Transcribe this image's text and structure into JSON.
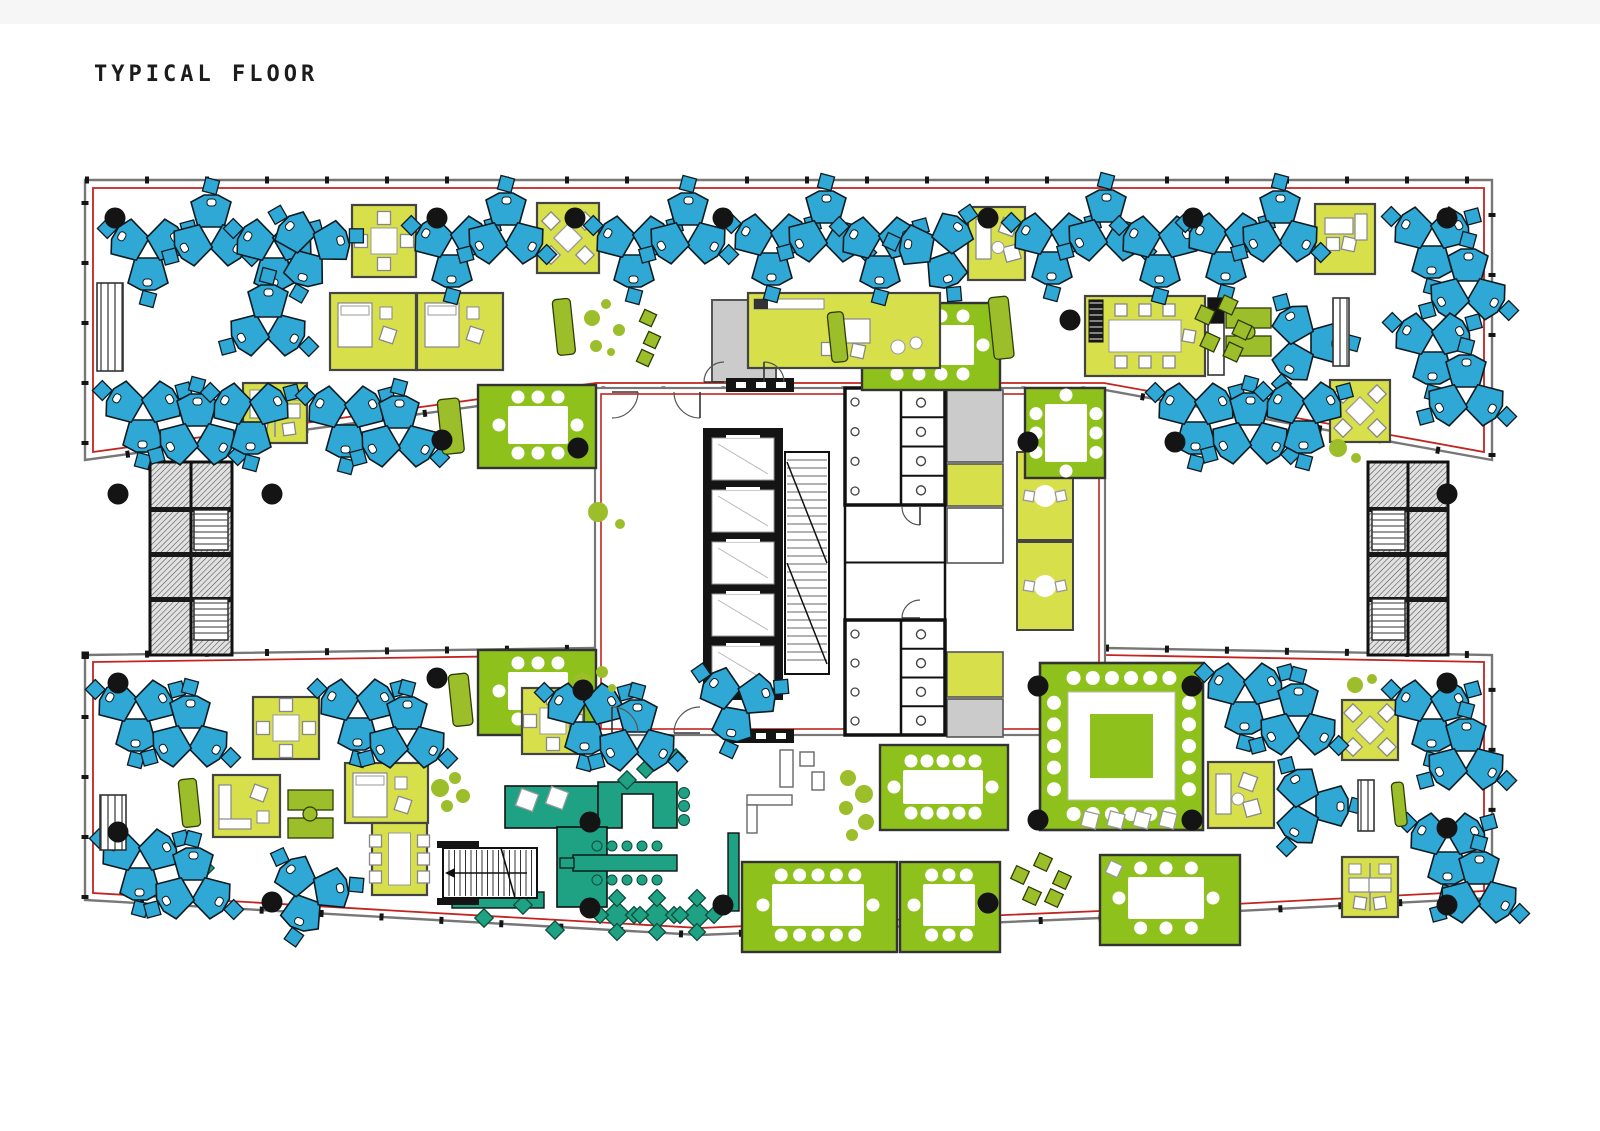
{
  "title": "TYPICAL FLOOR",
  "palette": {
    "blue": "#2FA8D5",
    "lime": "#D7DF4B",
    "green": "#8FC11C",
    "teal": "#1FA183",
    "olive": "#9CBE2B",
    "red": "#C22420",
    "wall": "#6E6E6E",
    "black": "#141414",
    "grayRoom": "#CBCBCB",
    "white": "#FFFFFF",
    "chairStroke": "#888888"
  },
  "plan": {
    "wings": {
      "top": {
        "outer": [
          [
            85,
            180
          ],
          [
            1492,
            180
          ],
          [
            1492,
            460
          ],
          [
            1105,
            390
          ],
          [
            595,
            390
          ],
          [
            85,
            460
          ]
        ],
        "red": [
          [
            93,
            188
          ],
          [
            1484,
            188
          ],
          [
            1484,
            452
          ],
          [
            1104,
            383
          ],
          [
            596,
            383
          ],
          [
            93,
            452
          ]
        ]
      },
      "bottom": {
        "outer": [
          [
            85,
            655
          ],
          [
            595,
            648
          ],
          [
            1105,
            648
          ],
          [
            1492,
            655
          ],
          [
            1492,
            898
          ],
          [
            1100,
            918
          ],
          [
            700,
            935
          ],
          [
            400,
            918
          ],
          [
            85,
            900
          ]
        ],
        "red": [
          [
            93,
            662
          ],
          [
            595,
            655
          ],
          [
            1105,
            655
          ],
          [
            1484,
            662
          ],
          [
            1484,
            891
          ],
          [
            1100,
            911
          ],
          [
            700,
            928
          ],
          [
            400,
            911
          ],
          [
            93,
            893
          ]
        ]
      }
    },
    "core": {
      "rect": [
        595,
        388,
        510,
        347
      ],
      "red": [
        601,
        394,
        498,
        335
      ],
      "grayRoom": [
        712,
        300,
        64,
        82
      ],
      "bars": [
        [
          726,
          378,
          68,
          14
        ],
        [
          726,
          729,
          68,
          14
        ]
      ],
      "elevBank": [
        703,
        428,
        80,
        272
      ],
      "carSize": [
        62,
        42
      ],
      "cars": [
        [
          712,
          438
        ],
        [
          712,
          490
        ],
        [
          712,
          542
        ],
        [
          712,
          594
        ],
        [
          712,
          646
        ]
      ],
      "scissor": [
        785,
        452,
        44,
        222
      ],
      "bathTop": [
        845,
        388,
        100,
        117
      ],
      "bathBottom": [
        845,
        620,
        100,
        115
      ],
      "midRooms": [
        845,
        505,
        100,
        115
      ],
      "grayCells": [
        [
          947,
          390,
          56,
          72
        ],
        [
          947,
          699,
          56,
          38
        ]
      ],
      "limeCells": [
        [
          947,
          464,
          56,
          42
        ],
        [
          947,
          652,
          56,
          45
        ]
      ],
      "whiteCells": [
        [
          947,
          508,
          56,
          55
        ]
      ],
      "phoneRooms": [
        [
          1017,
          452,
          56,
          88
        ],
        [
          1017,
          542,
          56,
          88
        ]
      ]
    },
    "extStairs": [
      [
        150,
        462,
        82,
        193,
        0
      ],
      [
        1368,
        462,
        80,
        193,
        1
      ]
    ],
    "cafeStair": [
      443,
      848,
      94,
      50
    ],
    "pods": [
      [
        148,
        252,
        90
      ],
      [
        211,
        233,
        270
      ],
      [
        274,
        252,
        90
      ],
      [
        311,
        248,
        105
      ],
      [
        452,
        249,
        90
      ],
      [
        506,
        231,
        270
      ],
      [
        634,
        249,
        90
      ],
      [
        688,
        231,
        270
      ],
      [
        772,
        247,
        90
      ],
      [
        826,
        229,
        270
      ],
      [
        880,
        250,
        90
      ],
      [
        938,
        250,
        70
      ],
      [
        1052,
        246,
        90
      ],
      [
        1106,
        228,
        270
      ],
      [
        1160,
        249,
        90
      ],
      [
        1226,
        246,
        90
      ],
      [
        1280,
        229,
        270
      ],
      [
        1432,
        240,
        90
      ],
      [
        1468,
        287,
        270
      ],
      [
        268,
        323,
        30
      ],
      [
        1305,
        343,
        0
      ],
      [
        1433,
        346,
        90
      ],
      [
        1466,
        393,
        270
      ],
      [
        143,
        414,
        90
      ],
      [
        197,
        432,
        270
      ],
      [
        251,
        416,
        90
      ],
      [
        346,
        419,
        90
      ],
      [
        399,
        434,
        270
      ],
      [
        1196,
        416,
        90
      ],
      [
        1250,
        431,
        270
      ],
      [
        1304,
        415,
        90
      ],
      [
        136,
        713,
        90
      ],
      [
        190,
        734,
        270
      ],
      [
        358,
        712,
        90
      ],
      [
        407,
        735,
        270
      ],
      [
        585,
        716,
        90
      ],
      [
        637,
        738,
        270
      ],
      [
        737,
        703,
        100
      ],
      [
        1245,
        696,
        90
      ],
      [
        1298,
        722,
        270
      ],
      [
        1432,
        713,
        90
      ],
      [
        1466,
        757,
        270
      ],
      [
        1310,
        806,
        0
      ],
      [
        1448,
        846,
        90
      ],
      [
        1479,
        890,
        270
      ],
      [
        140,
        862,
        90
      ],
      [
        193,
        886,
        270
      ],
      [
        310,
        893,
        110
      ]
    ],
    "booths": [
      [
        352,
        205,
        64,
        72,
        "table4"
      ],
      [
        537,
        203,
        62,
        70,
        "xtable"
      ],
      [
        968,
        207,
        57,
        73,
        "lounge"
      ],
      [
        1315,
        204,
        60,
        70,
        "desk1"
      ],
      [
        330,
        293,
        86,
        77,
        "bed"
      ],
      [
        417,
        293,
        86,
        77,
        "bed"
      ],
      [
        748,
        293,
        192,
        75,
        "av"
      ],
      [
        1085,
        296,
        120,
        80,
        "table8h"
      ],
      [
        243,
        383,
        64,
        60,
        "desk2"
      ],
      [
        1330,
        380,
        60,
        62,
        "xtable"
      ],
      [
        253,
        697,
        66,
        62,
        "table4"
      ],
      [
        522,
        688,
        62,
        66,
        "table4"
      ],
      [
        1342,
        700,
        56,
        60,
        "xtable"
      ],
      [
        213,
        775,
        67,
        62,
        "sofaL"
      ],
      [
        345,
        763,
        83,
        60,
        "bed"
      ],
      [
        372,
        823,
        55,
        72,
        "table6v"
      ],
      [
        1208,
        762,
        66,
        66,
        "lounge"
      ],
      [
        1342,
        857,
        56,
        60,
        "desk2"
      ]
    ],
    "greenRooms": [
      {
        "x": 478,
        "y": 385,
        "w": 118,
        "h": 83,
        "table": [
          508,
          406,
          60,
          38
        ],
        "chairs": [
          3,
          3,
          1,
          1
        ]
      },
      {
        "x": 1025,
        "y": 388,
        "w": 80,
        "h": 90,
        "table": [
          1045,
          404,
          42,
          58
        ],
        "chairs": [
          1,
          1,
          3,
          3
        ]
      },
      {
        "x": 862,
        "y": 303,
        "w": 138,
        "h": 87,
        "table": [
          886,
          325,
          88,
          40
        ],
        "chairs": [
          4,
          4,
          1,
          1
        ]
      },
      {
        "x": 478,
        "y": 650,
        "w": 118,
        "h": 85,
        "table": [
          508,
          672,
          60,
          38
        ],
        "chairs": [
          3,
          3,
          1,
          1
        ]
      },
      {
        "x": 880,
        "y": 745,
        "w": 128,
        "h": 85,
        "table": [
          903,
          770,
          80,
          34
        ],
        "chairs": [
          5,
          5,
          1,
          1
        ]
      },
      {
        "x": 742,
        "y": 862,
        "w": 155,
        "h": 90,
        "table": [
          772,
          884,
          92,
          42
        ],
        "chairs": [
          5,
          5,
          1,
          1
        ]
      },
      {
        "x": 900,
        "y": 862,
        "w": 100,
        "h": 90,
        "table": [
          923,
          884,
          52,
          42
        ],
        "chairs": [
          3,
          3,
          1,
          1
        ]
      },
      {
        "x": 1100,
        "y": 855,
        "w": 140,
        "h": 90,
        "table": [
          1128,
          877,
          76,
          42
        ],
        "chairs": [
          3,
          3,
          1,
          1
        ],
        "tilt": true
      }
    ],
    "bigRoom": {
      "x": 1040,
      "y": 663,
      "w": 163,
      "h": 167,
      "ring": [
        1068,
        692,
        107,
        108
      ],
      "inner": [
        1090,
        714,
        63,
        64
      ]
    },
    "cafe": {
      "sofaPlate": [
        505,
        786,
        103,
        42
      ],
      "pillows": [
        [
          527,
          800
        ],
        [
          557,
          798
        ]
      ],
      "uBar": [
        [
          598,
          782
        ],
        [
          677,
          782
        ],
        [
          677,
          828
        ],
        [
          653,
          828
        ],
        [
          653,
          794
        ],
        [
          622,
          794
        ],
        [
          622,
          828
        ],
        [
          598,
          828
        ]
      ],
      "kiosk": [
        557,
        827,
        50,
        80
      ],
      "island": [
        573,
        855,
        104,
        16
      ],
      "handle": [
        560,
        858,
        14,
        10
      ],
      "stoolRows": [
        {
          "y": 846,
          "xs": [
            597,
            612,
            627,
            642,
            657
          ]
        },
        {
          "y": 880,
          "xs": [
            597,
            612,
            627,
            642,
            657
          ]
        }
      ],
      "stoolsSide": [
        [
          684,
          793
        ],
        [
          684,
          806
        ],
        [
          684,
          820
        ]
      ],
      "counter": [
        728,
        833,
        11,
        78
      ],
      "underbar": [
        452,
        892,
        92,
        16
      ],
      "tables": [
        [
          617,
          915
        ],
        [
          657,
          915
        ],
        [
          697,
          915
        ]
      ],
      "diamonds": [
        [
          484,
          918
        ],
        [
          523,
          905
        ],
        [
          555,
          930
        ],
        [
          627,
          780
        ],
        [
          646,
          769
        ],
        [
          676,
          758
        ],
        [
          205,
          868
        ]
      ]
    },
    "screens": [
      [
        988,
        298,
        20,
        62
      ],
      [
        437,
        400,
        22,
        55
      ],
      [
        448,
        675,
        20,
        52
      ],
      [
        178,
        780,
        18,
        48
      ],
      [
        1391,
        783,
        12,
        44
      ],
      [
        827,
        313,
        16,
        50
      ],
      [
        552,
        300,
        18,
        56
      ]
    ],
    "shelves": [
      [
        97,
        283,
        26,
        88
      ],
      [
        100,
        795,
        26,
        55
      ],
      [
        1333,
        298,
        16,
        68
      ],
      [
        1358,
        780,
        16,
        51
      ]
    ],
    "cabinets": [
      [
        1208,
        298,
        16,
        77
      ]
    ],
    "deskPairs": [
      [
        1226,
        308
      ],
      [
        288,
        790
      ]
    ],
    "whiteFurniture": [
      [
        780,
        750,
        13,
        37
      ],
      [
        800,
        752,
        14,
        14
      ],
      [
        747,
        795,
        45,
        10
      ],
      [
        747,
        805,
        10,
        28
      ],
      [
        812,
        772,
        12,
        18
      ]
    ],
    "organicChairs": [
      [
        648,
        318,
        13
      ],
      [
        652,
        340,
        13
      ],
      [
        645,
        358,
        13
      ],
      [
        1205,
        315,
        15
      ],
      [
        1228,
        305,
        15
      ],
      [
        1242,
        330,
        15
      ],
      [
        1210,
        342,
        15
      ],
      [
        1233,
        352,
        15
      ],
      [
        1020,
        875,
        14
      ],
      [
        1043,
        862,
        14
      ],
      [
        1062,
        880,
        14
      ],
      [
        1032,
        896,
        14
      ],
      [
        1054,
        898,
        14
      ]
    ],
    "plants": [
      [
        592,
        318,
        8
      ],
      [
        606,
        304,
        5
      ],
      [
        619,
        330,
        6
      ],
      [
        596,
        346,
        6
      ],
      [
        611,
        352,
        4
      ],
      [
        598,
        512,
        10
      ],
      [
        620,
        524,
        5
      ],
      [
        1338,
        448,
        9
      ],
      [
        1356,
        458,
        5
      ],
      [
        583,
        682,
        9
      ],
      [
        602,
        672,
        6
      ],
      [
        612,
        688,
        4
      ],
      [
        440,
        788,
        9
      ],
      [
        455,
        778,
        6
      ],
      [
        463,
        796,
        7
      ],
      [
        447,
        806,
        6
      ],
      [
        848,
        778,
        8
      ],
      [
        864,
        794,
        9
      ],
      [
        846,
        808,
        7
      ],
      [
        866,
        822,
        8
      ],
      [
        852,
        835,
        6
      ],
      [
        1355,
        685,
        8
      ],
      [
        1372,
        679,
        5
      ]
    ],
    "columns": [
      [
        115,
        218
      ],
      [
        437,
        218
      ],
      [
        575,
        218
      ],
      [
        723,
        218
      ],
      [
        988,
        218
      ],
      [
        1193,
        218
      ],
      [
        1447,
        218
      ],
      [
        1070,
        320
      ],
      [
        118,
        494
      ],
      [
        272,
        494
      ],
      [
        442,
        440
      ],
      [
        578,
        448
      ],
      [
        1028,
        442
      ],
      [
        1175,
        442
      ],
      [
        1447,
        494
      ],
      [
        118,
        683
      ],
      [
        437,
        678
      ],
      [
        583,
        690
      ],
      [
        1038,
        686
      ],
      [
        1192,
        686
      ],
      [
        1447,
        683
      ],
      [
        118,
        832
      ],
      [
        590,
        822
      ],
      [
        1038,
        820
      ],
      [
        1192,
        820
      ],
      [
        1447,
        828
      ],
      [
        272,
        902
      ],
      [
        590,
        908
      ],
      [
        723,
        905
      ],
      [
        988,
        903
      ],
      [
        1447,
        905
      ]
    ],
    "doors": [
      [
        612,
        392,
        26,
        0
      ],
      [
        700,
        392,
        26,
        90
      ],
      [
        724,
        382,
        20,
        180
      ],
      [
        764,
        382,
        20,
        270
      ],
      [
        612,
        733,
        26,
        270
      ],
      [
        700,
        733,
        26,
        180
      ],
      [
        920,
        507,
        18,
        90
      ],
      [
        920,
        618,
        18,
        180
      ]
    ]
  }
}
